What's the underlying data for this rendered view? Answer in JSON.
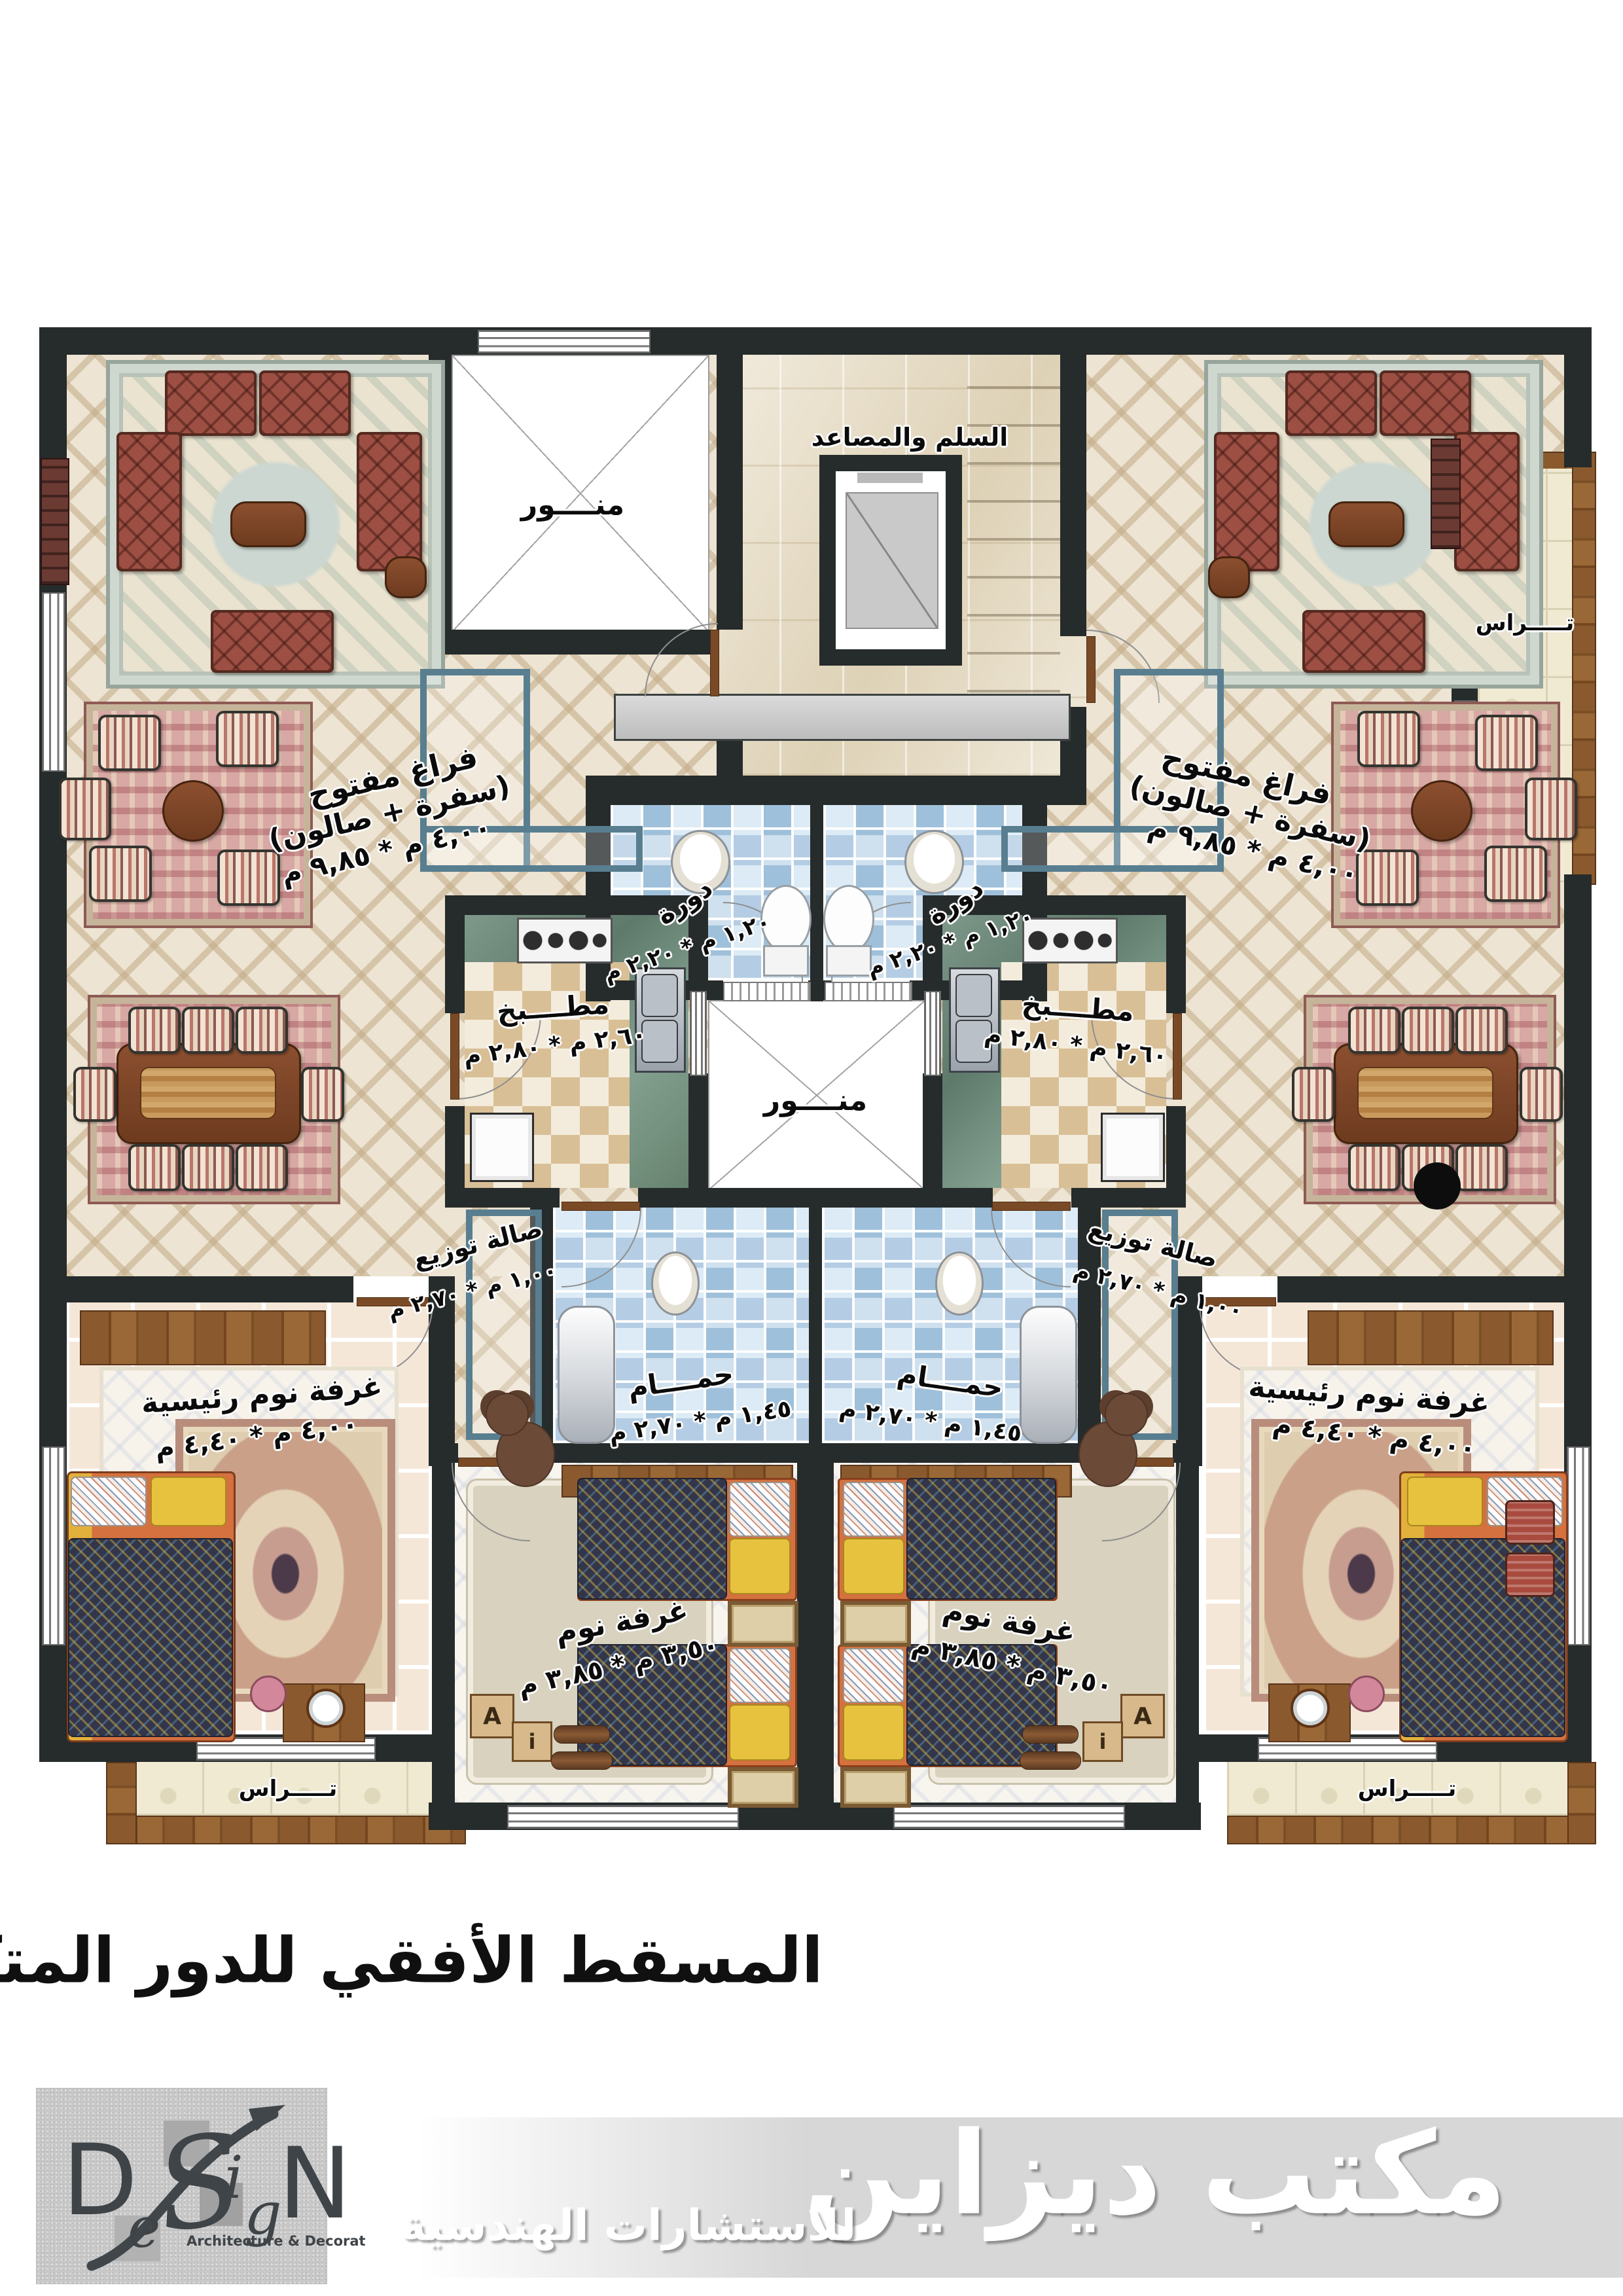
{
  "caption": "المسقط الأفقي للدور المتكرر",
  "plan": {
    "core": {
      "stairs_label": "السلم والمصاعد"
    },
    "light_well_label": "منــــور",
    "rooms": {
      "open_space": {
        "l1": "فراغ مفتوح",
        "l2": "(سفرة + صالون)",
        "dims": "٤,٠٠ م * ٩,٨٥ م"
      },
      "wc": {
        "label": "دورة",
        "dims": "١,٢٠ م * ٢,٢٠ م"
      },
      "kitchen": {
        "label": "مطــــبخ",
        "dims": "٢,٦٠ م * ٢,٨٠ م"
      },
      "hall": {
        "label": "صالة توزيع",
        "dims": "١,٠٠ م * ٢,٧٠ م"
      },
      "bath": {
        "label": "حمــــام",
        "dims": "١,٤٥ م * ٢,٧٠ م"
      },
      "master_bedroom": {
        "label": "غرفة نوم رئيسية",
        "dims": "٤,٠٠ م * ٤,٤٠ م"
      },
      "bedroom": {
        "label": "غرفة نوم",
        "dims": "٣,٥٠ م * ٣,٨٥ م"
      },
      "terrace": {
        "label": "تـــــراس"
      }
    },
    "toys": {
      "block1": "A",
      "block2": "i"
    }
  },
  "logo": {
    "d": "D",
    "e": "e",
    "s": "S",
    "i": "i",
    "g": "g",
    "n": "N",
    "tagline": "Architecture & Decoration"
  },
  "banner": {
    "main": "مكتب ديزاين",
    "sub": "للاستشارات الهندسية"
  },
  "colors": {
    "wall": "#262b2b",
    "blue_tile": "#abc8e0",
    "green_marble": "#74907e",
    "wood": "#8a5a2e",
    "terracotta_sofa": "#9d4f43",
    "accent_teal": "#587e90",
    "marble": "#e9dfc8",
    "lattice_floor": "#ede4d3"
  }
}
